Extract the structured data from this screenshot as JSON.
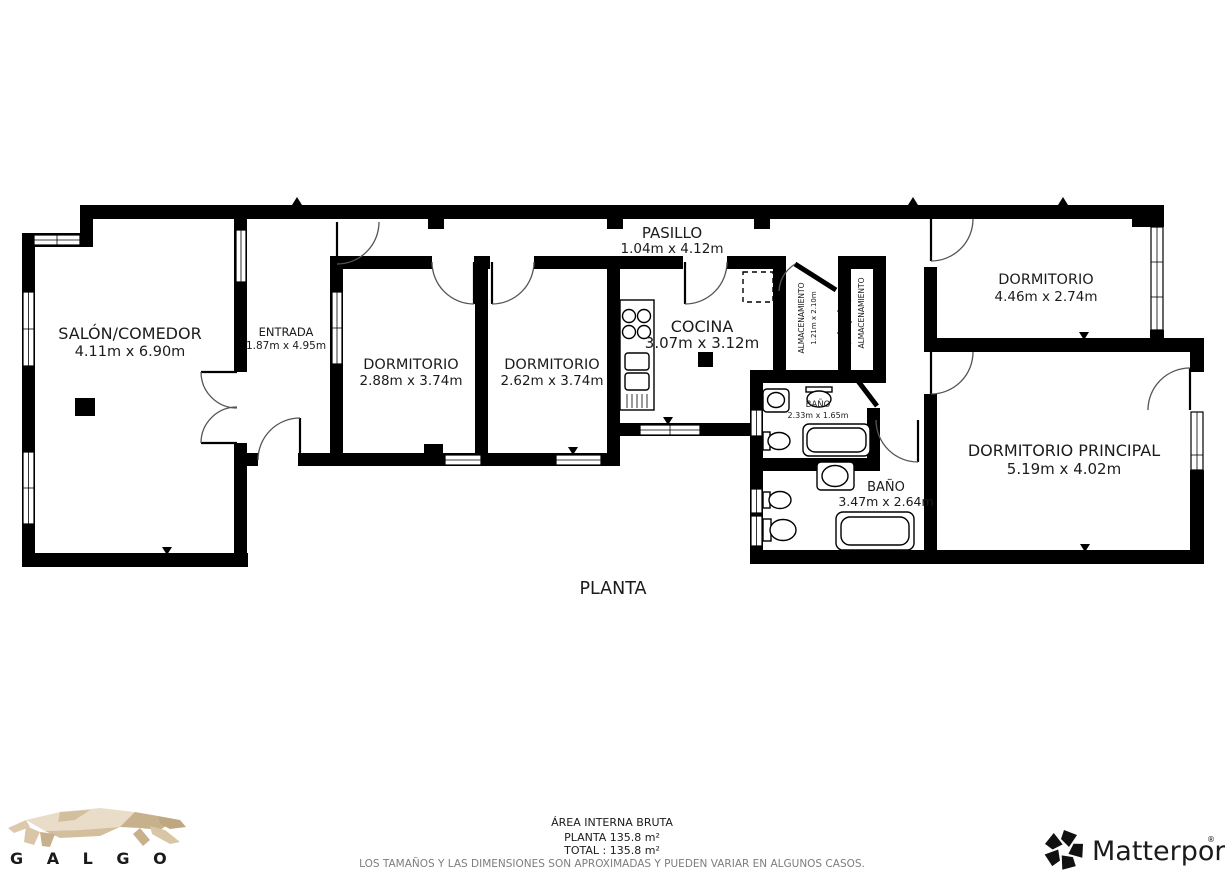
{
  "floorplan": {
    "title": "PLANTA",
    "rooms": {
      "salon": {
        "name": "SALÓN/COMEDOR",
        "dims": "4.11m x 6.90m"
      },
      "entrada": {
        "name": "ENTRADA",
        "dims": "1.87m x 4.95m"
      },
      "dormitorio1": {
        "name": "DORMITORIO",
        "dims": "2.88m x 3.74m"
      },
      "dormitorio2": {
        "name": "DORMITORIO",
        "dims": "2.62m x 3.74m"
      },
      "cocina": {
        "name": "COCINA",
        "dims": "3.07m x 3.12m"
      },
      "pasillo": {
        "name": "PASILLO",
        "dims": "1.04m x 4.12m"
      },
      "almacenamiento1": {
        "name": "ALMACENAMIENTO",
        "dims": "1.21m x 2.10m"
      },
      "almacenamiento2": {
        "name": "ALMACENAMIENTO"
      },
      "dormitorio3": {
        "name": "DORMITORIO",
        "dims": "4.46m x 2.74m"
      },
      "bano_small": {
        "name": "BAÑO",
        "dims": "2.33m x 1.65m"
      },
      "bano_large": {
        "name": "BAÑO",
        "dims": "3.47m x 2.64m"
      },
      "principal": {
        "name": "DORMITORIO PRINCIPAL",
        "dims": "5.19m x 4.02m"
      }
    },
    "footer": {
      "area_title": "ÁREA INTERNA BRUTA",
      "planta_area": "PLANTA 135.8 m²",
      "total_area": "TOTAL :  135.8 m²",
      "disclaimer": "LOS TAMAÑOS Y LAS DIMENSIONES SON APROXIMADAS Y PUEDEN VARIAR EN ALGUNOS CASOS."
    },
    "colors": {
      "wall": "#000000",
      "disclaimer_text": "#7d7d7d",
      "galgo_text": "#8c8c8c",
      "galgo_poly_light": "#e9ddc9",
      "galgo_poly_mid": "#dbc9ab",
      "galgo_poly_dark": "#c7b08c",
      "matterport_text": "#111111"
    }
  },
  "branding": {
    "galgo_label": "G A L G O",
    "matterport_label": "Matterport",
    "registered_mark": "®"
  }
}
